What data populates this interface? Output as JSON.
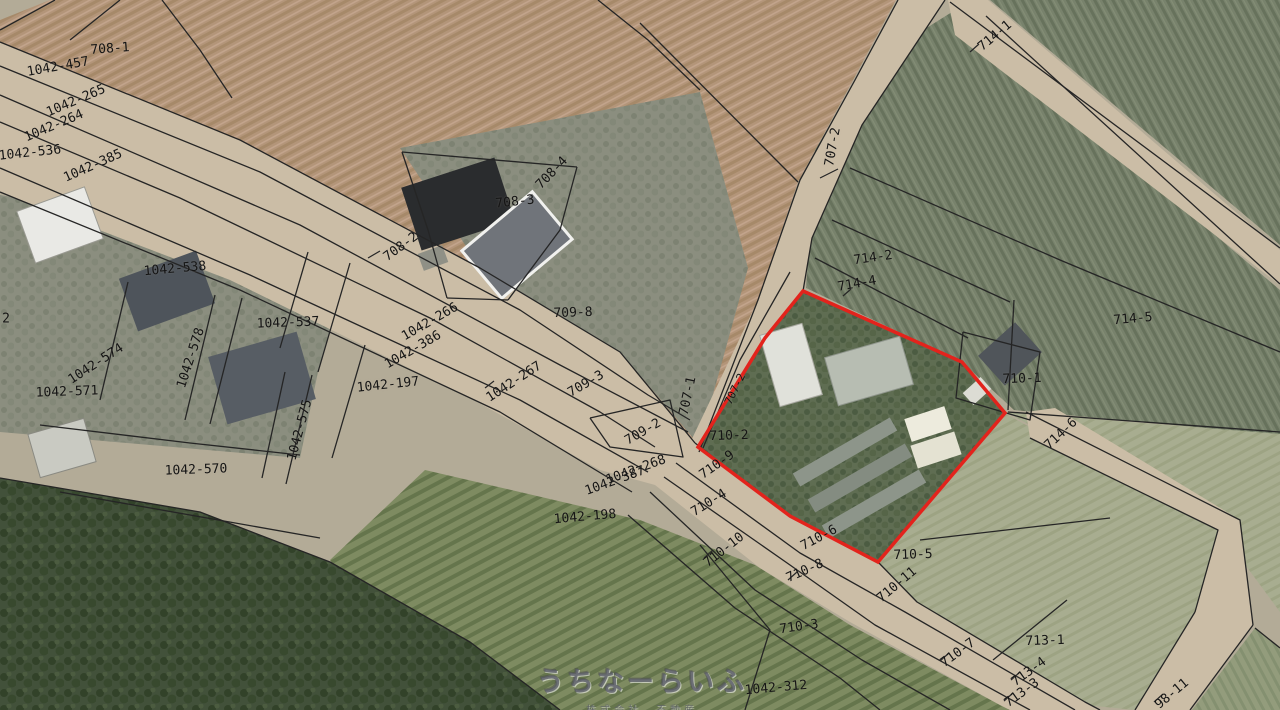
{
  "map": {
    "width": 1280,
    "height": 710,
    "background": "#b3ab97",
    "line_color": "#252525",
    "road_fill": "#cbbda6",
    "red_parcel": {
      "points": "803,291 962,362 1005,413 878,562 790,516 698,447 765,338",
      "color": "#e3231c",
      "stroke_width": 3.5
    },
    "fields": [
      {
        "id": "field-plowed-708",
        "fill": "furrow",
        "pts": "50,0 896,0 852,82 798,182 758,300 699,452 620,352 480,268 240,140 0,42 0,20"
      },
      {
        "id": "orchard-714-wedge",
        "fill": "orchard",
        "pts": "952,12 1280,290 1280,435 1014,410 962,362 806,288 815,150 866,66"
      },
      {
        "id": "orchard-714-corner",
        "fill": "orchard",
        "pts": "990,0 1280,0 1280,245"
      },
      {
        "id": "residential-left",
        "fill": "resid",
        "pts": "0,195 60,205 350,265 318,372 300,458 0,432"
      },
      {
        "id": "block-708-3",
        "fill": "resid",
        "pts": "400,148 700,92 748,268 699,445 620,352 482,270"
      },
      {
        "id": "pale-field-right-upper",
        "fill": "pale",
        "pts": "1006,412 1280,434 1280,612 1218,528"
      },
      {
        "id": "pale-field-710-5-713-1",
        "fill": "pale",
        "pts": "1006,414 1218,530 1195,612 1135,710 1085,705 917,602 878,562"
      },
      {
        "id": "orchard-rows-bottom",
        "fill": "rows",
        "pts": "425,470 640,520 755,565 850,625 1000,705 1010,710 430,710 330,560"
      },
      {
        "id": "forest-bottom-left",
        "fill": "forest",
        "pts": "0,478 200,512 330,562 470,642 560,710 0,710"
      },
      {
        "id": "corner-field-bottom-right",
        "fill": "corner",
        "pts": "1255,628 1280,648 1280,710 1192,710"
      }
    ],
    "roads": [
      {
        "id": "main-road",
        "pts": "0,42 240,140 480,268 620,352 695,443 790,517 878,562 917,602 1085,702 1100,710 1010,710 1000,705 850,622 760,568 655,485 600,470 470,398 230,280 0,192"
      },
      {
        "id": "branch-road-707-2",
        "pts": "898,0 945,0 862,125 812,238 803,291 765,340 702,452 690,443 758,300 800,180 855,80"
      },
      {
        "id": "branch-road-ne",
        "pts": "948,0 988,0 1280,250 1280,285 955,35"
      },
      {
        "id": "strip-road-714-6",
        "pts": "1026,412 1055,408 1240,520 1253,625 1190,710 1135,710 1195,612 1218,530 1030,438"
      }
    ],
    "boundary_lines": [
      "0,42 240,140 480,268 620,352 695,443",
      "0,66 260,172 520,310 648,395 690,420",
      "0,95 300,225 560,365 688,432",
      "0,122 180,198 430,318 600,412 655,447",
      "0,168 250,275 520,400 648,472",
      "0,192 240,290 500,412 632,492",
      "695,443 790,517 878,562 917,602 1085,702 1100,710",
      "676,463 800,553 905,612 1075,710",
      "664,477 790,565 875,625 1030,710",
      "650,492 755,590 862,660 950,710",
      "628,515 735,608 840,678 880,710",
      "640,23 798,182",
      "898,0 855,80 800,180 758,300 699,452",
      "945,0 862,125 812,238 803,291",
      "790,272 740,360 703,448",
      "950,2 1280,248",
      "986,16 1280,284",
      "850,168 1060,260 1280,352",
      "832,220 1010,302",
      "815,258 968,338",
      "1014,300 1008,410",
      "1008,412 1280,432",
      "1026,412 1240,520 1253,625",
      "1030,438 1218,530 1195,612",
      "1195,612 1135,710",
      "1253,625 1190,710",
      "1067,600 993,660",
      "920,540 1110,518",
      "1255,628 1280,648",
      "55,0 0,30",
      "120,0 70,40",
      "162,0 200,50 232,98",
      "598,0 648,40 700,90",
      "402,152 577,167",
      "577,167 560,230 508,300",
      "402,152 428,230 447,298",
      "447,298 508,300",
      "308,252 280,348",
      "350,263 318,372",
      "215,295 185,420",
      "242,298 210,424",
      "128,282 100,400",
      "40,425 190,443 300,455",
      "60,492 320,538",
      "285,372 262,478",
      "312,375 286,484",
      "590,418 670,400 683,457 610,447 590,418",
      "365,345 332,458",
      "700,545 770,630 745,710",
      "0,478 200,512 330,562 470,642 560,710",
      "963,332 1040,352 1030,420 956,398 963,332"
    ],
    "leader_ticks": [
      "368,258 380,251",
      "820,178 838,169",
      "970,52 979,44",
      "843,296 851,289",
      "788,580 797,572",
      "704,558 713,550",
      "940,661 949,653",
      "1011,680 1020,672",
      "1004,701 1013,693",
      "1154,702 1163,694",
      "485,388 494,381"
    ],
    "buildings": [
      {
        "x": 60,
        "y": 225,
        "w": 72,
        "h": 55,
        "r": -20,
        "fill": "#e9e9e5",
        "stroke": "#9a9a92",
        "sw": 1
      },
      {
        "x": 167,
        "y": 291,
        "w": 82,
        "h": 56,
        "r": -20,
        "fill": "#4e545b"
      },
      {
        "x": 262,
        "y": 378,
        "w": 92,
        "h": 70,
        "r": -16,
        "fill": "#575d64"
      },
      {
        "x": 62,
        "y": 448,
        "w": 58,
        "h": 45,
        "r": -16,
        "fill": "#c9cac2",
        "stroke": "#8a8a82",
        "sw": 1
      },
      {
        "x": 458,
        "y": 204,
        "w": 98,
        "h": 66,
        "r": -18,
        "fill": "#2a2c2e"
      },
      {
        "x": 517,
        "y": 245,
        "w": 92,
        "h": 62,
        "r": -40,
        "fill": "#70747a",
        "stroke": "#f1f1ee",
        "sw": 3
      },
      {
        "x": 433,
        "y": 258,
        "w": 26,
        "h": 18,
        "r": -20,
        "fill": "#8f9086"
      },
      {
        "x": 791,
        "y": 365,
        "w": 44,
        "h": 74,
        "r": -16,
        "fill": "#e0e1da",
        "stroke": "#a8a8a0",
        "sw": 1
      },
      {
        "x": 869,
        "y": 371,
        "w": 78,
        "h": 50,
        "r": -16,
        "fill": "#b7bdb2",
        "stroke": "#8f958c",
        "sw": 1
      },
      {
        "x": 845,
        "y": 452,
        "w": 112,
        "h": 15,
        "r": -30,
        "fill": "#8d958a"
      },
      {
        "x": 860,
        "y": 478,
        "w": 112,
        "h": 15,
        "r": -30,
        "fill": "#848c81"
      },
      {
        "x": 874,
        "y": 504,
        "w": 112,
        "h": 15,
        "r": -30,
        "fill": "#8d958a"
      },
      {
        "x": 928,
        "y": 424,
        "w": 42,
        "h": 24,
        "r": -18,
        "fill": "#edebdd"
      },
      {
        "x": 936,
        "y": 450,
        "w": 46,
        "h": 24,
        "r": -18,
        "fill": "#e4e2d2"
      },
      {
        "x": 1010,
        "y": 354,
        "w": 50,
        "h": 40,
        "r": -42,
        "fill": "#50555a"
      },
      {
        "x": 977,
        "y": 391,
        "w": 24,
        "h": 16,
        "r": -42,
        "fill": "#dcdcd4"
      }
    ]
  },
  "labels": [
    {
      "t": "708-1",
      "x": 110,
      "y": 49,
      "r": -4
    },
    {
      "t": "1042-457",
      "x": 58,
      "y": 67,
      "r": -10
    },
    {
      "t": "1042-265",
      "x": 76,
      "y": 101,
      "r": -23
    },
    {
      "t": "1042-264",
      "x": 54,
      "y": 126,
      "r": -23
    },
    {
      "t": "1042-536",
      "x": 30,
      "y": 153,
      "r": -6
    },
    {
      "t": "1042-385",
      "x": 93,
      "y": 166,
      "r": -24
    },
    {
      "t": "1042-538",
      "x": 175,
      "y": 269,
      "r": -5
    },
    {
      "t": "1042-537",
      "x": 288,
      "y": 323,
      "r": -2
    },
    {
      "t": "1042-578",
      "x": 191,
      "y": 358,
      "r": -72
    },
    {
      "t": "1042-574",
      "x": 96,
      "y": 364,
      "r": -33
    },
    {
      "t": "1042-571",
      "x": 67,
      "y": 392,
      "r": -2
    },
    {
      "t": "1042-575",
      "x": 300,
      "y": 430,
      "r": -75
    },
    {
      "t": "1042-570",
      "x": 196,
      "y": 470,
      "r": -2
    },
    {
      "t": "2",
      "x": 6,
      "y": 319,
      "r": 0
    },
    {
      "t": "708-4",
      "x": 552,
      "y": 173,
      "r": -46
    },
    {
      "t": "708-3",
      "x": 515,
      "y": 202,
      "r": -6
    },
    {
      "t": "708-2",
      "x": 401,
      "y": 247,
      "r": -36
    },
    {
      "t": "709-8",
      "x": 573,
      "y": 313,
      "r": -2
    },
    {
      "t": "1042-266",
      "x": 430,
      "y": 322,
      "r": -30
    },
    {
      "t": "1042-386",
      "x": 413,
      "y": 350,
      "r": -30
    },
    {
      "t": "1042-267",
      "x": 514,
      "y": 382,
      "r": -33
    },
    {
      "t": "1042-197",
      "x": 388,
      "y": 385,
      "r": -6
    },
    {
      "t": "709-3",
      "x": 586,
      "y": 384,
      "r": -30
    },
    {
      "t": "707-1",
      "x": 688,
      "y": 396,
      "r": -78
    },
    {
      "t": "707-2",
      "x": 735,
      "y": 389,
      "r": -64,
      "s": 11
    },
    {
      "t": "709-2",
      "x": 643,
      "y": 432,
      "r": -30
    },
    {
      "t": "710-2",
      "x": 729,
      "y": 436,
      "r": -2
    },
    {
      "t": "1042-268",
      "x": 636,
      "y": 470,
      "r": -20
    },
    {
      "t": "1042-387",
      "x": 615,
      "y": 481,
      "r": -20
    },
    {
      "t": "710-9",
      "x": 717,
      "y": 465,
      "r": -35
    },
    {
      "t": "710-4",
      "x": 709,
      "y": 503,
      "r": -32
    },
    {
      "t": "1042-198",
      "x": 585,
      "y": 517,
      "r": -5
    },
    {
      "t": "710-10",
      "x": 724,
      "y": 550,
      "r": -38
    },
    {
      "t": "710-6",
      "x": 819,
      "y": 538,
      "r": -28
    },
    {
      "t": "710-8",
      "x": 805,
      "y": 571,
      "r": -24
    },
    {
      "t": "714-1",
      "x": 995,
      "y": 36,
      "r": -40
    },
    {
      "t": "707-2",
      "x": 833,
      "y": 147,
      "r": -80
    },
    {
      "t": "714-2",
      "x": 873,
      "y": 258,
      "r": -8
    },
    {
      "t": "714-4",
      "x": 857,
      "y": 284,
      "r": -10
    },
    {
      "t": "714-5",
      "x": 1133,
      "y": 319,
      "r": -5
    },
    {
      "t": "710-1",
      "x": 1022,
      "y": 379,
      "r": -2
    },
    {
      "t": "714-6",
      "x": 1061,
      "y": 434,
      "r": -43
    },
    {
      "t": "710-5",
      "x": 913,
      "y": 555,
      "r": -2
    },
    {
      "t": "710-11",
      "x": 897,
      "y": 585,
      "r": -40
    },
    {
      "t": "713-1",
      "x": 1045,
      "y": 641,
      "r": -2
    },
    {
      "t": "710-7",
      "x": 958,
      "y": 653,
      "r": -36
    },
    {
      "t": "713-4",
      "x": 1029,
      "y": 672,
      "r": -36
    },
    {
      "t": "713-3",
      "x": 1022,
      "y": 693,
      "r": -36
    },
    {
      "t": "98-11",
      "x": 1172,
      "y": 694,
      "r": -40
    },
    {
      "t": "710-3",
      "x": 799,
      "y": 627,
      "r": -8
    },
    {
      "t": "1042-312",
      "x": 776,
      "y": 688,
      "r": -5
    }
  ],
  "watermark": {
    "title": "うちなーらいふ",
    "subtitle": "株式会社　不動産",
    "x": 642,
    "y": 676
  }
}
